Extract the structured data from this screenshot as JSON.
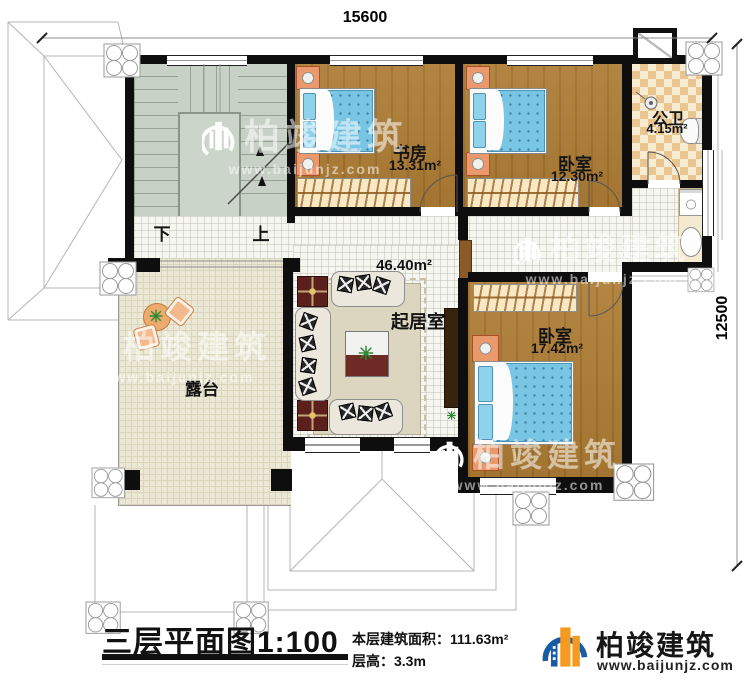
{
  "dimensions": {
    "width": "15600",
    "depth": "12500"
  },
  "rooms": {
    "study": {
      "name": "书房",
      "area": "13.31m²"
    },
    "bedroom_top": {
      "name": "卧室",
      "area": "12.30m²"
    },
    "bathroom": {
      "name": "公卫",
      "area": "4.15m²"
    },
    "living_room": {
      "name": "起居室",
      "area": "46.40m²"
    },
    "bedroom_bottom": {
      "name": "卧室",
      "area": "17.42m²"
    },
    "terrace": {
      "name": "露台"
    }
  },
  "stairs": {
    "down": "下",
    "up": "上"
  },
  "title_block": {
    "title": "三层平面图1:100",
    "floor_area": "本层建筑面积：111.63m²",
    "floor_height": "层高：3.3m"
  },
  "brand": {
    "name": "柏竣建筑",
    "website": "www.baijunjz.com"
  },
  "watermark": {
    "name": "柏竣建筑",
    "website": "www.baijunjz.com"
  },
  "colors": {
    "wall": "#0e0e0e",
    "wood_floor": "#ad7c34",
    "bed_blue": "#79c5e4",
    "stair_green": "#c8d1c5",
    "bath_tile": "#e9c58f",
    "terrace": "#ebe8d5",
    "brand_blue": "#1a5ba6",
    "brand_orange": "#f5991f"
  }
}
